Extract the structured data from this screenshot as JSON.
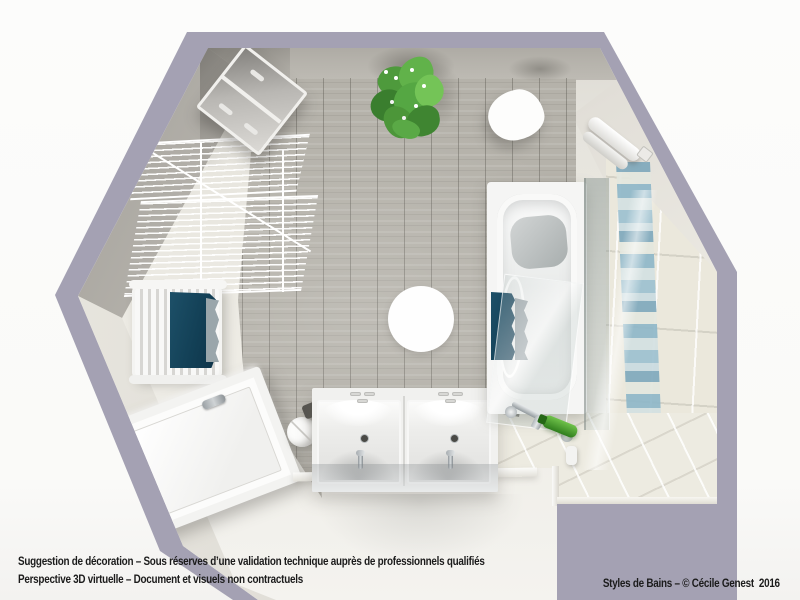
{
  "captions": {
    "line1": "Suggestion de décoration – Sous réserves d’une validation technique auprès de professionnels qualifiés",
    "line2": "Perspective 3D virtuelle – Document et visuels non contractuels",
    "credit": "Styles de Bains – © Cécile Genest  2016"
  },
  "colors": {
    "wall_outline_purple": "#a4a1b3",
    "wood_floor": "#b5b2aa",
    "tile_floor": "#edebe1",
    "mosaic_blue": "#8fb7c8",
    "towel_teal": "#123f55",
    "plant_green": "#55a743",
    "fixture_white": "#f5f5f4"
  },
  "scene": {
    "view": "top-down 3D perspective of a bathroom",
    "fixtures": [
      "laundry-basket",
      "wire-shelving-rack",
      "towel-radiator-with-teal-towel",
      "shower-tray",
      "round-stool",
      "double-sink-vanity",
      "round-rug",
      "pebble-side-table",
      "potted-plant",
      "rolled-towels-rail",
      "bathtub-with-glass-screen",
      "bathtub-faucet",
      "mosaic-accent-wall-strip"
    ]
  }
}
